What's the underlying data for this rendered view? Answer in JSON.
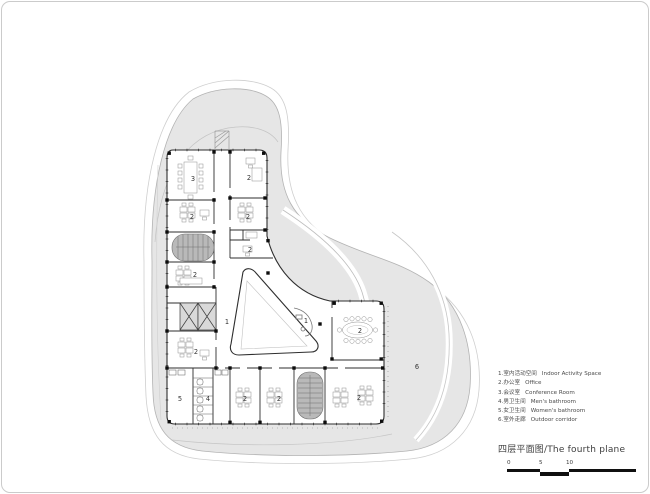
{
  "title": {
    "text": "四层平面图/The fourth plane"
  },
  "legend": {
    "items": [
      {
        "zh": "1.室内活动空间",
        "en": "Indoor Activity Space"
      },
      {
        "zh": "2.办公室",
        "en": "Office"
      },
      {
        "zh": "3.会议室",
        "en": "Conference Room"
      },
      {
        "zh": "4.男卫生间",
        "en": "Men's bathroom"
      },
      {
        "zh": "5.女卫生间",
        "en": "Women's bathroom"
      },
      {
        "zh": "6.室外走廊",
        "en": "Outdoor corridor"
      }
    ]
  },
  "scale_bar": {
    "labels": [
      "0",
      "5",
      "10"
    ]
  },
  "plan": {
    "room_labels": [
      {
        "text": "3"
      },
      {
        "text": "2"
      },
      {
        "text": "2"
      },
      {
        "text": "2"
      },
      {
        "text": "2"
      },
      {
        "text": "2"
      },
      {
        "text": "2"
      },
      {
        "text": "1"
      },
      {
        "text": "1"
      },
      {
        "text": "2"
      },
      {
        "text": "6"
      },
      {
        "text": "5"
      },
      {
        "text": "4"
      },
      {
        "text": "2"
      },
      {
        "text": "2"
      },
      {
        "text": "2"
      }
    ],
    "colors": {
      "site_fill": "#e6e6e6",
      "site_outline": "#b3b3b3",
      "contour": "#c4c4c4",
      "wall": "#2e2e2e",
      "stair_fill": "#b9b9b9",
      "label": "#333333",
      "scalebar": "#101010"
    }
  }
}
